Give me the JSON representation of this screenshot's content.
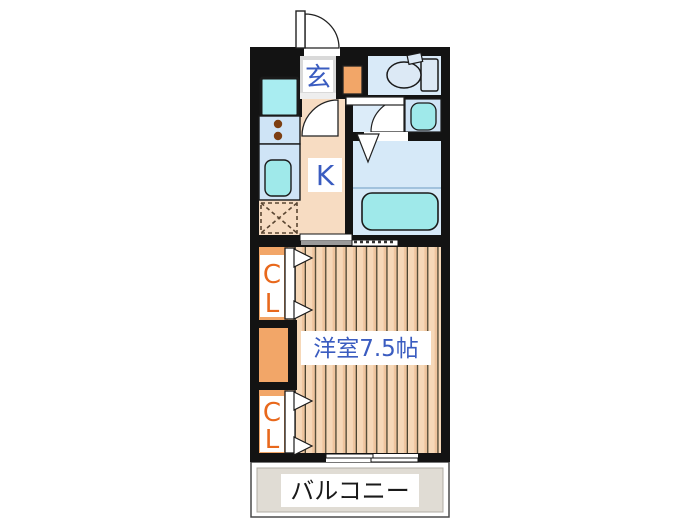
{
  "floorplan": {
    "type": "japanese-apartment-floorplan",
    "rooms": {
      "entrance": {
        "label": "玄"
      },
      "kitchen": {
        "label": "K"
      },
      "main_room": {
        "label": "洋室7.5帖",
        "size_jo": 7.5
      },
      "balcony": {
        "label": "バルコニー"
      },
      "closet_upper": {
        "label": "CL",
        "chars": [
          "C",
          "L"
        ]
      },
      "closet_lower": {
        "label": "CL",
        "chars": [
          "C",
          "L"
        ]
      }
    },
    "fixtures": [
      "entrance-door",
      "toilet",
      "washbasin",
      "bathtub",
      "washing-machine-pan",
      "kitchen-sink",
      "stove-burners",
      "refrigerator-space",
      "sliding-door",
      "sliding-window",
      "closet-folding-doors",
      "bathroom-folding-door"
    ],
    "colors": {
      "wall_black": "#131313",
      "kitchen_floor": "#f7dcc2",
      "wood_light": "#f6d8b8",
      "wood_mid": "#eec49e",
      "wood_dark": "#4a432f",
      "wet_floor": "#d6e9f8",
      "wet_floor_light": "#dcecf9",
      "counter_blue": "#cfe4f6",
      "fixture_teal": "#9fe9ea",
      "washer_teal": "#a9edf1",
      "closet_orange": "#f2a668",
      "genkan_gray": "#d9d9d9",
      "balcony_gray": "#e0dcd4",
      "label_blue": "#3a5cc0",
      "label_orange": "#e8681c",
      "label_black": "#1a1a1a"
    }
  }
}
